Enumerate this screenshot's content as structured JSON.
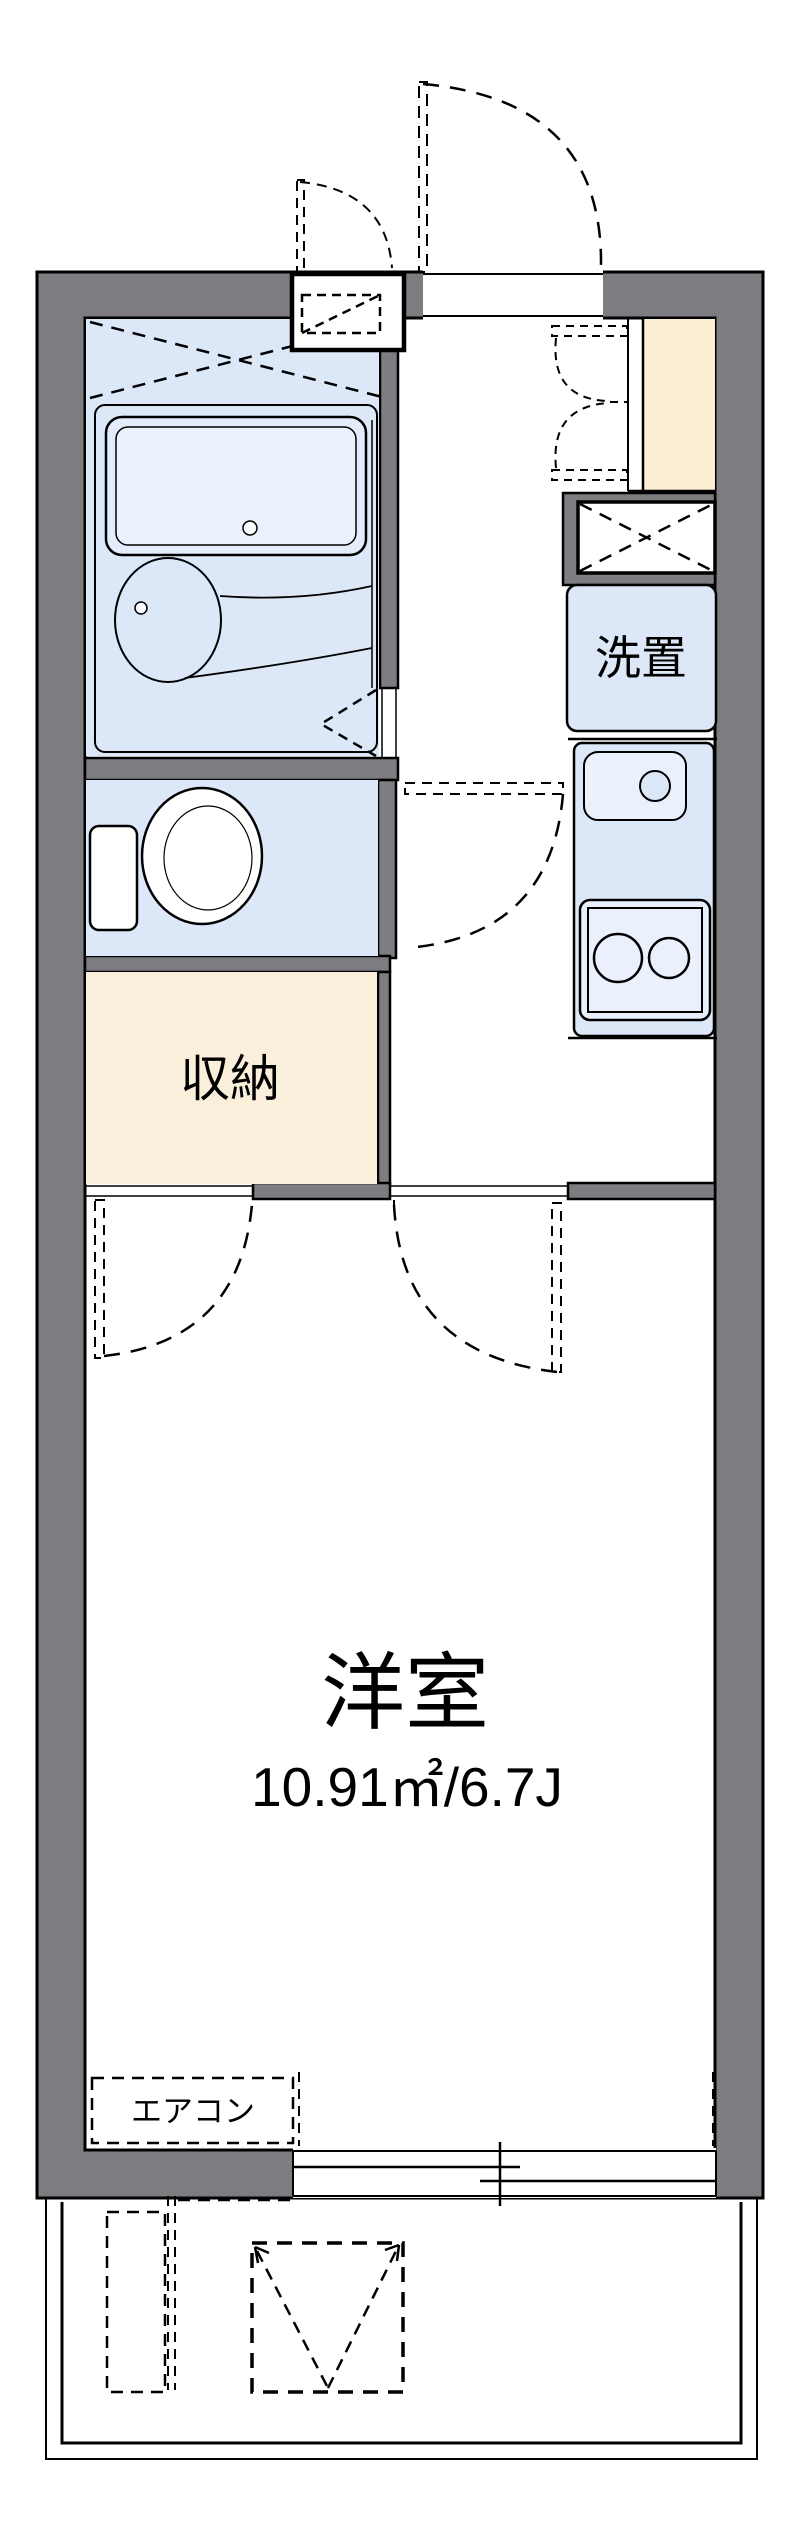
{
  "plan": {
    "type": "apartment-floor-plan",
    "rooms": {
      "laundry": {
        "label": "洗置"
      },
      "storage": {
        "label": "収納"
      },
      "western": {
        "label": "洋室",
        "area": "10.91㎡/6.7J"
      },
      "ac": {
        "label": "エアコン"
      }
    },
    "colors": {
      "wall_gray": "#7c7c81",
      "outline_black": "#000000",
      "wet_room_blue": "#dce7f7",
      "fixture_blue": "#eaf1fc",
      "storage_cream": "#faefdb",
      "entrance_beige": "#fbeed3",
      "background": "#ffffff"
    }
  }
}
